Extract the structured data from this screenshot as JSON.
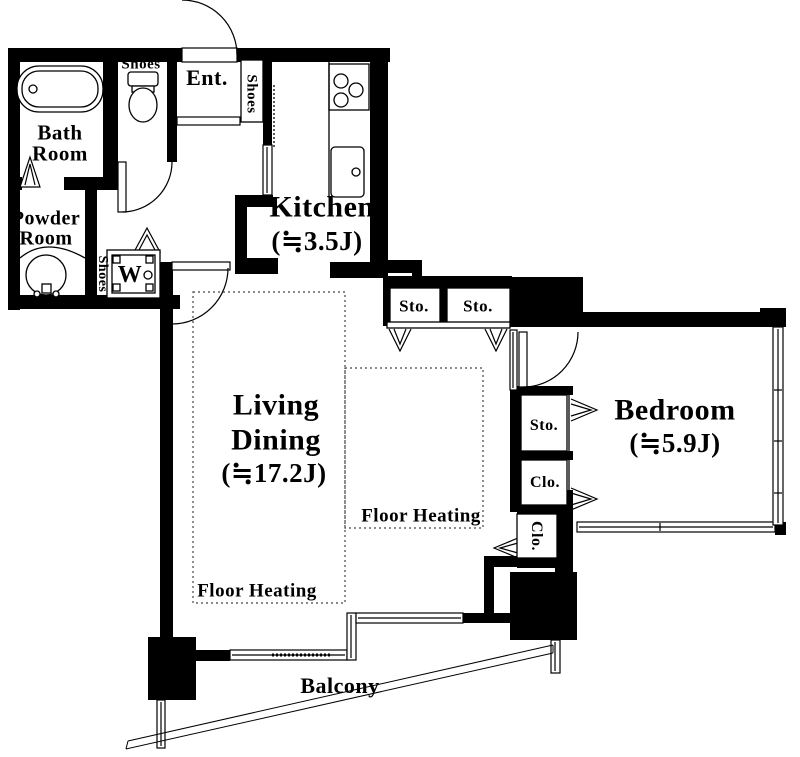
{
  "colors": {
    "wall": "#000000",
    "background": "#ffffff",
    "text": "#000000"
  },
  "rooms": {
    "bath": {
      "line1": "Bath",
      "line2": "Room"
    },
    "powder": {
      "line1": "Powder",
      "line2": "Room"
    },
    "entrance": {
      "label": "Ent."
    },
    "kitchen": {
      "label": "Kitchen",
      "size": "(≒3.5J)"
    },
    "living": {
      "line1": "Living",
      "line2": "Dining",
      "size": "(≒17.2J)"
    },
    "bedroom": {
      "label": "Bedroom",
      "size": "(≒5.9J)"
    },
    "balcony": {
      "label": "Balcony"
    }
  },
  "storage": {
    "shoes_toilet": "Shoes",
    "shoes_entrance": "Shoes",
    "shoes_washer": "Shoes",
    "hall_sto_1": "Sto.",
    "hall_sto_2": "Sto.",
    "bedroom_sto": "Sto.",
    "bedroom_clo": "Clo.",
    "bedroom_clo2": "Clo."
  },
  "fixtures": {
    "washer": "W"
  },
  "features": {
    "floor_heating_1": "Floor Heating",
    "floor_heating_2": "Floor Heating"
  }
}
